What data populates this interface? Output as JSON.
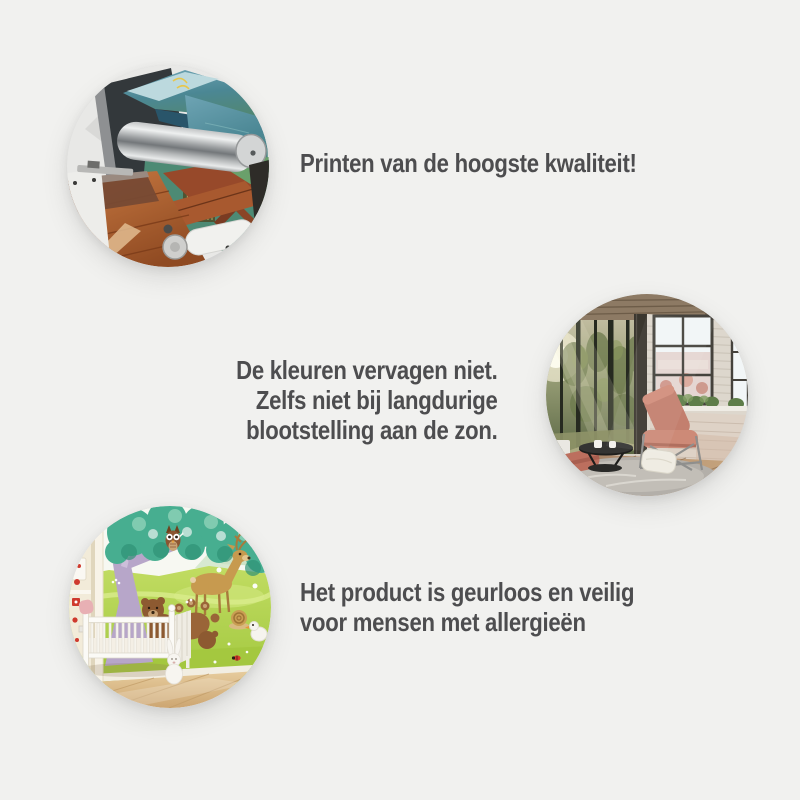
{
  "canvas": {
    "background": "#f1f1ef",
    "text_color": "#4d4d4f"
  },
  "benefits": [
    {
      "id": "print-quality",
      "photo_alt": "wall mural being printed on a large-format printer",
      "lines": [
        "Printen van de hoogste kwaliteit!"
      ]
    },
    {
      "id": "fade-resistant",
      "photo_alt": "sunlit loft living room with forest wall mural",
      "lines": [
        "De kleuren vervagen niet.",
        "Zelfs niet bij langdurige",
        "blootstelling aan de zon."
      ]
    },
    {
      "id": "odorless-allergy-safe",
      "photo_alt": "nursery with cartoon forest animals wall mural and white crib",
      "lines": [
        "Het product is geurloos en veilig",
        "voor mensen met allergieën"
      ]
    }
  ]
}
